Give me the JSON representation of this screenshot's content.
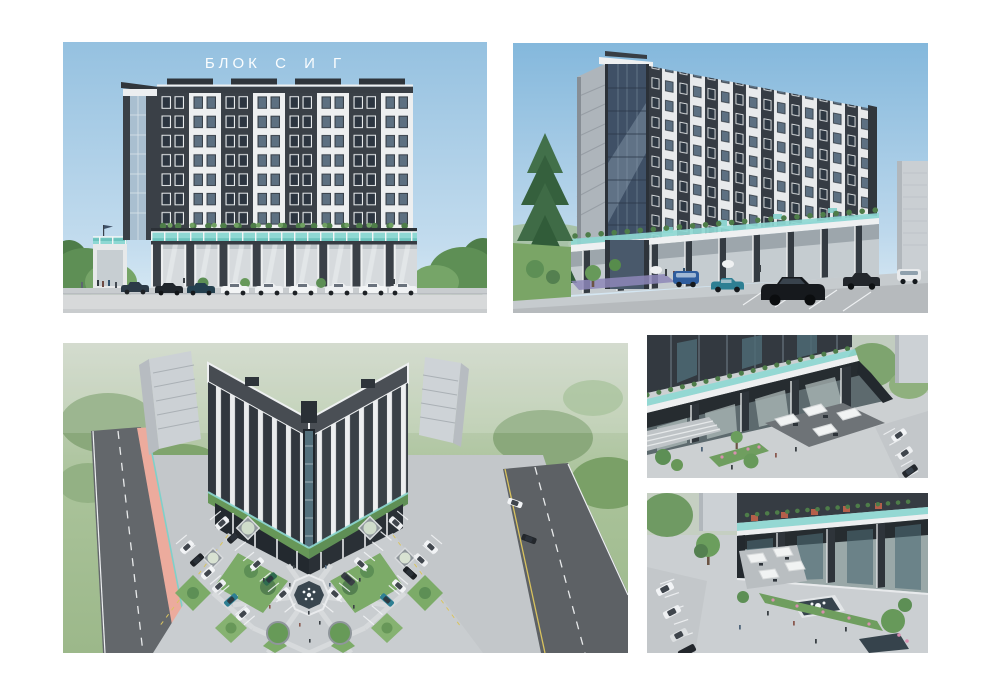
{
  "title": {
    "text": "БЛОК С И Г",
    "color": "#ffffff"
  },
  "panels": {
    "top_left": "front-elevation-render",
    "top_right": "corner-perspective-render",
    "bottom_left": "aerial-plaza-render",
    "right_middle": "ground-floor-terrace-closeup-render",
    "right_bottom": "plaza-fountain-closeup-render"
  },
  "palette": {
    "page_background": "#ffffff",
    "sky_top": "#95c1e0",
    "sky_bottom": "#dcecf5",
    "facade_dark": "#3a4047",
    "facade_white": "#eef0f1",
    "glass_teal": "#8ed8d3",
    "curtain_glass": "#3f5066",
    "greenery": "#5d8f55",
    "grass_aerial": "#a5c096",
    "road_dark": "#5f6367",
    "pavement": "#c6cacd",
    "bike_lane": "#ecab9d",
    "planter_terracotta": "#b55f4a"
  }
}
